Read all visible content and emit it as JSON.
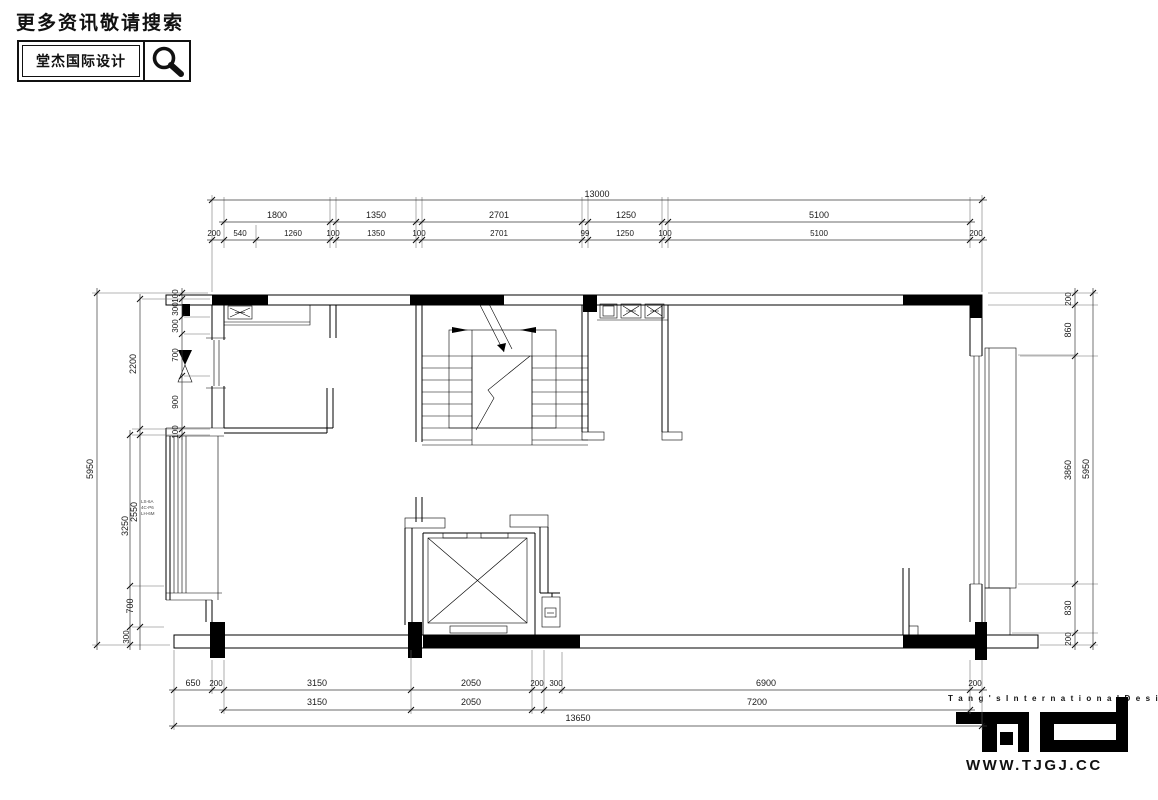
{
  "header": {
    "search_hint": "更多资讯敬请搜索",
    "brand_name": "堂杰国际设计"
  },
  "footer": {
    "tagline": "T a n g ' s   I n t e r n a t i o n a l   D e s i g n",
    "website": "WWW.TJGJ.CC"
  },
  "annotations": {
    "window_note": [
      "LS-6A",
      "4C-P6",
      "LH-6M"
    ]
  },
  "dims": {
    "top_total": "13000",
    "top_row2": [
      "1800",
      "1350",
      "2701",
      "1250",
      "5100"
    ],
    "top_row3": [
      "200",
      "540",
      "1260",
      "100",
      "1350",
      "100",
      "2701",
      "99",
      "1250",
      "100",
      "5100",
      "200"
    ],
    "left_outer": "5950",
    "left_mid": [
      "2200",
      "3250"
    ],
    "left_inner_upper": [
      "100",
      "300",
      "300",
      "700",
      "900",
      "100"
    ],
    "left_inner_lower": [
      "2550",
      "700",
      "300"
    ],
    "right_inner": [
      "200",
      "860",
      "3860",
      "830",
      "200"
    ],
    "right_outer": "5950",
    "bottom_row1": [
      "650",
      "200",
      "3150",
      "2050",
      "200",
      "300",
      "6900",
      "200"
    ],
    "bottom_row2": [
      "3150",
      "2050",
      "7200"
    ],
    "bottom_total": "13650"
  }
}
